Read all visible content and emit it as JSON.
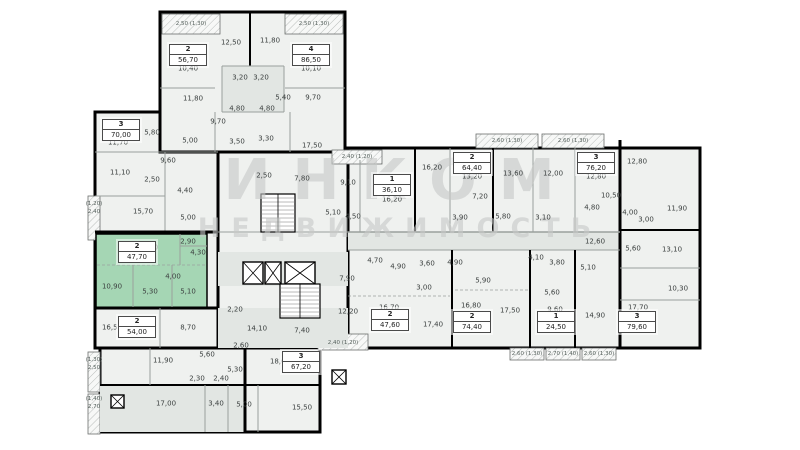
{
  "watermark": {
    "line1": "ИНКОМ",
    "line2": "НЕДВИЖИМОСТЬ"
  },
  "colors": {
    "highlight": "#a5d6b4",
    "wall": "#000000",
    "partition": "#9aa09d",
    "room_fill": "#eff1ef",
    "shaded_fill": "#e2e6e3",
    "balcony_stroke": "#6b6f6d",
    "label_text": "#3c4140",
    "watermark_gray": "#c7c9c8"
  },
  "selected_unit": {
    "rooms": "2",
    "area": "47,70"
  },
  "units": [
    {
      "rooms": "3",
      "area": "70,00",
      "x": 121,
      "y": 130,
      "selected": false
    },
    {
      "rooms": "2",
      "area": "47,70",
      "x": 137,
      "y": 252,
      "selected": true
    },
    {
      "rooms": "2",
      "area": "54,00",
      "x": 137,
      "y": 327,
      "selected": false
    },
    {
      "rooms": "2",
      "area": "56,70",
      "x": 188,
      "y": 55,
      "selected": false
    },
    {
      "rooms": "4",
      "area": "86,50",
      "x": 311,
      "y": 55,
      "selected": false
    },
    {
      "rooms": "1",
      "area": "36,10",
      "x": 392,
      "y": 185,
      "selected": false
    },
    {
      "rooms": "2",
      "area": "64,40",
      "x": 472,
      "y": 163,
      "selected": false
    },
    {
      "rooms": "3",
      "area": "76,20",
      "x": 596,
      "y": 163,
      "selected": false
    },
    {
      "rooms": "2",
      "area": "47,60",
      "x": 390,
      "y": 320,
      "selected": false
    },
    {
      "rooms": "2",
      "area": "74,40",
      "x": 472,
      "y": 322,
      "selected": false
    },
    {
      "rooms": "1",
      "area": "24,50",
      "x": 556,
      "y": 322,
      "selected": false
    },
    {
      "rooms": "3",
      "area": "79,60",
      "x": 637,
      "y": 322,
      "selected": false
    },
    {
      "rooms": "3",
      "area": "67,20",
      "x": 301,
      "y": 362,
      "selected": false
    }
  ],
  "room_labels": [
    {
      "t": "10,40",
      "x": 188,
      "y": 69
    },
    {
      "t": "12,50",
      "x": 231,
      "y": 43
    },
    {
      "t": "11,80",
      "x": 270,
      "y": 41
    },
    {
      "t": "10,10",
      "x": 311,
      "y": 69
    },
    {
      "t": "11,80",
      "x": 193,
      "y": 99
    },
    {
      "t": "3,20",
      "x": 240,
      "y": 78
    },
    {
      "t": "3,20",
      "x": 261,
      "y": 78
    },
    {
      "t": "5,40",
      "x": 283,
      "y": 98
    },
    {
      "t": "9,70",
      "x": 313,
      "y": 98
    },
    {
      "t": "4,80",
      "x": 237,
      "y": 109
    },
    {
      "t": "4,80",
      "x": 267,
      "y": 109
    },
    {
      "t": "9,70",
      "x": 218,
      "y": 122
    },
    {
      "t": "3,50",
      "x": 237,
      "y": 142
    },
    {
      "t": "3,30",
      "x": 266,
      "y": 139
    },
    {
      "t": "17,50",
      "x": 312,
      "y": 146
    },
    {
      "t": "5,00",
      "x": 190,
      "y": 141
    },
    {
      "t": "11,70",
      "x": 118,
      "y": 143
    },
    {
      "t": "5,80",
      "x": 152,
      "y": 133
    },
    {
      "t": "11,10",
      "x": 120,
      "y": 173
    },
    {
      "t": "2,50",
      "x": 152,
      "y": 180
    },
    {
      "t": "9,60",
      "x": 168,
      "y": 161
    },
    {
      "t": "4,40",
      "x": 185,
      "y": 191
    },
    {
      "t": "15,70",
      "x": 143,
      "y": 212
    },
    {
      "t": "5,00",
      "x": 188,
      "y": 218
    },
    {
      "t": "13,60",
      "x": 148,
      "y": 248
    },
    {
      "t": "2,90",
      "x": 188,
      "y": 242
    },
    {
      "t": "4,30",
      "x": 198,
      "y": 253
    },
    {
      "t": "10,90",
      "x": 112,
      "y": 287
    },
    {
      "t": "4,00",
      "x": 173,
      "y": 277
    },
    {
      "t": "5,30",
      "x": 150,
      "y": 292
    },
    {
      "t": "5,10",
      "x": 188,
      "y": 292
    },
    {
      "t": "16,50",
      "x": 112,
      "y": 328
    },
    {
      "t": "8,70",
      "x": 188,
      "y": 328
    },
    {
      "t": "2,20",
      "x": 235,
      "y": 310
    },
    {
      "t": "14,10",
      "x": 257,
      "y": 329
    },
    {
      "t": "7,40",
      "x": 302,
      "y": 331
    },
    {
      "t": "2,50",
      "x": 264,
      "y": 176
    },
    {
      "t": "7,80",
      "x": 302,
      "y": 179
    },
    {
      "t": "5,10",
      "x": 333,
      "y": 213
    },
    {
      "t": "4,50",
      "x": 353,
      "y": 217
    },
    {
      "t": "11,90",
      "x": 163,
      "y": 361
    },
    {
      "t": "5,60",
      "x": 207,
      "y": 355
    },
    {
      "t": "2,60",
      "x": 241,
      "y": 346
    },
    {
      "t": "5,30",
      "x": 235,
      "y": 370
    },
    {
      "t": "2,30",
      "x": 197,
      "y": 379
    },
    {
      "t": "2,40",
      "x": 221,
      "y": 379
    },
    {
      "t": "17,00",
      "x": 166,
      "y": 404
    },
    {
      "t": "3,40",
      "x": 216,
      "y": 404
    },
    {
      "t": "5,00",
      "x": 244,
      "y": 405
    },
    {
      "t": "15,50",
      "x": 302,
      "y": 408
    },
    {
      "t": "18,60",
      "x": 280,
      "y": 362
    },
    {
      "t": "9,10",
      "x": 348,
      "y": 183
    },
    {
      "t": "16,20",
      "x": 392,
      "y": 200
    },
    {
      "t": "16,20",
      "x": 432,
      "y": 168
    },
    {
      "t": "13,20",
      "x": 472,
      "y": 177
    },
    {
      "t": "7,20",
      "x": 480,
      "y": 197
    },
    {
      "t": "3,90",
      "x": 460,
      "y": 218
    },
    {
      "t": "5,80",
      "x": 503,
      "y": 217
    },
    {
      "t": "13,60",
      "x": 513,
      "y": 174
    },
    {
      "t": "12,00",
      "x": 553,
      "y": 174
    },
    {
      "t": "12,80",
      "x": 596,
      "y": 177
    },
    {
      "t": "12,80",
      "x": 637,
      "y": 162
    },
    {
      "t": "10,50",
      "x": 611,
      "y": 196
    },
    {
      "t": "4,80",
      "x": 592,
      "y": 208
    },
    {
      "t": "4,00",
      "x": 630,
      "y": 213
    },
    {
      "t": "3,00",
      "x": 646,
      "y": 220
    },
    {
      "t": "11,90",
      "x": 677,
      "y": 209
    },
    {
      "t": "3,10",
      "x": 543,
      "y": 218
    },
    {
      "t": "13,10",
      "x": 672,
      "y": 250
    },
    {
      "t": "5,60",
      "x": 633,
      "y": 249
    },
    {
      "t": "12,60",
      "x": 595,
      "y": 242
    },
    {
      "t": "10,30",
      "x": 678,
      "y": 289
    },
    {
      "t": "4,70",
      "x": 375,
      "y": 261
    },
    {
      "t": "4,90",
      "x": 398,
      "y": 267
    },
    {
      "t": "3,60",
      "x": 427,
      "y": 264
    },
    {
      "t": "4,90",
      "x": 455,
      "y": 263
    },
    {
      "t": "4,10",
      "x": 536,
      "y": 258
    },
    {
      "t": "3,80",
      "x": 557,
      "y": 263
    },
    {
      "t": "5,10",
      "x": 588,
      "y": 268
    },
    {
      "t": "5,60",
      "x": 552,
      "y": 293
    },
    {
      "t": "9,60",
      "x": 555,
      "y": 310
    },
    {
      "t": "7,90",
      "x": 347,
      "y": 279
    },
    {
      "t": "3,00",
      "x": 424,
      "y": 288
    },
    {
      "t": "5,90",
      "x": 483,
      "y": 281
    },
    {
      "t": "12,20",
      "x": 348,
      "y": 312
    },
    {
      "t": "16,70",
      "x": 389,
      "y": 308
    },
    {
      "t": "17,40",
      "x": 433,
      "y": 325
    },
    {
      "t": "16,80",
      "x": 471,
      "y": 306
    },
    {
      "t": "17,50",
      "x": 510,
      "y": 311
    },
    {
      "t": "14,90",
      "x": 595,
      "y": 316
    },
    {
      "t": "17,70",
      "x": 638,
      "y": 308
    }
  ],
  "balcony_labels": [
    {
      "t": "2,50 (1,30)",
      "x": 191,
      "y": 24
    },
    {
      "t": "2,50 (1,30)",
      "x": 314,
      "y": 24
    },
    {
      "t": "(1,20)",
      "x": 94,
      "y": 204
    },
    {
      "t": "2,40",
      "x": 94,
      "y": 212
    },
    {
      "t": "2,40 (1,20)",
      "x": 357,
      "y": 157
    },
    {
      "t": "2,60 (1,30)",
      "x": 507,
      "y": 141
    },
    {
      "t": "2,60 (1,30)",
      "x": 573,
      "y": 141
    },
    {
      "t": "(1,30)",
      "x": 94,
      "y": 360
    },
    {
      "t": "2,50",
      "x": 94,
      "y": 368
    },
    {
      "t": "(1,40)",
      "x": 94,
      "y": 399
    },
    {
      "t": "2,70",
      "x": 94,
      "y": 407
    },
    {
      "t": "2,40 (1,20)",
      "x": 343,
      "y": 343
    },
    {
      "t": "2,60 (1,30)",
      "x": 527,
      "y": 354
    },
    {
      "t": "2,70 (1,40)",
      "x": 563,
      "y": 354
    },
    {
      "t": "2,60 (1,30)",
      "x": 599,
      "y": 354
    }
  ],
  "geometry": {
    "blocks": [
      [
        95,
        112,
        123,
        236
      ],
      [
        218,
        152,
        130,
        196
      ],
      [
        100,
        348,
        220,
        84
      ],
      [
        160,
        12,
        185,
        140
      ],
      [
        348,
        148,
        352,
        200
      ]
    ],
    "green_unit": [
      96,
      234,
      111,
      74
    ],
    "shaded": [
      [
        218,
        252,
        130,
        34
      ],
      [
        348,
        232,
        272,
        18
      ],
      [
        222,
        66,
        62,
        46
      ],
      [
        100,
        385,
        145,
        47
      ],
      [
        218,
        308,
        130,
        40
      ]
    ],
    "walls": [
      [
        250,
        12,
        250,
        66,
        2
      ],
      [
        222,
        66,
        284,
        66,
        1
      ],
      [
        222,
        66,
        222,
        112,
        1
      ],
      [
        284,
        66,
        284,
        112,
        1
      ],
      [
        222,
        112,
        284,
        112,
        1
      ],
      [
        160,
        88,
        215,
        88,
        1
      ],
      [
        285,
        88,
        345,
        88,
        1
      ],
      [
        215,
        112,
        215,
        152,
        1
      ],
      [
        290,
        112,
        290,
        152,
        1
      ],
      [
        95,
        152,
        218,
        152,
        1
      ],
      [
        95,
        196,
        165,
        196,
        1
      ],
      [
        165,
        152,
        165,
        232,
        1
      ],
      [
        95,
        232,
        218,
        232,
        3
      ],
      [
        95,
        308,
        218,
        308,
        3
      ],
      [
        180,
        234,
        180,
        265,
        1
      ],
      [
        180,
        246,
        207,
        246,
        1
      ],
      [
        133,
        265,
        133,
        307,
        1
      ],
      [
        172,
        265,
        172,
        307,
        1
      ],
      [
        160,
        308,
        160,
        348,
        1
      ],
      [
        100,
        385,
        320,
        385,
        2
      ],
      [
        245,
        348,
        245,
        432,
        3
      ],
      [
        205,
        385,
        205,
        432,
        1
      ],
      [
        228,
        385,
        228,
        432,
        1
      ],
      [
        258,
        385,
        258,
        432,
        1
      ],
      [
        150,
        348,
        150,
        385,
        1
      ],
      [
        218,
        232,
        348,
        232,
        1
      ],
      [
        415,
        148,
        415,
        232,
        2
      ],
      [
        493,
        148,
        493,
        232,
        2
      ],
      [
        360,
        160,
        360,
        232,
        1
      ],
      [
        450,
        148,
        450,
        232,
        1
      ],
      [
        533,
        148,
        533,
        232,
        1
      ],
      [
        575,
        148,
        575,
        232,
        1
      ],
      [
        620,
        140,
        620,
        348,
        3
      ],
      [
        620,
        230,
        700,
        230,
        2
      ],
      [
        348,
        232,
        620,
        232,
        1.5
      ],
      [
        348,
        250,
        620,
        250,
        1
      ],
      [
        452,
        250,
        452,
        348,
        2
      ],
      [
        530,
        250,
        530,
        348,
        2
      ],
      [
        575,
        250,
        575,
        348,
        2
      ],
      [
        620,
        268,
        700,
        268,
        1
      ],
      [
        620,
        300,
        700,
        300,
        1
      ]
    ],
    "dashed": [
      [
        97,
        265,
        205,
        265
      ],
      [
        348,
        296,
        450,
        296
      ],
      [
        455,
        290,
        528,
        290
      ]
    ],
    "balconies": [
      [
        162,
        14,
        58,
        20
      ],
      [
        285,
        14,
        58,
        20
      ],
      [
        88,
        196,
        12,
        44
      ],
      [
        88,
        352,
        12,
        40
      ],
      [
        88,
        394,
        12,
        40
      ],
      [
        332,
        150,
        50,
        14
      ],
      [
        476,
        134,
        62,
        14
      ],
      [
        542,
        134,
        62,
        14
      ],
      [
        318,
        334,
        50,
        16
      ],
      [
        510,
        348,
        34,
        12
      ],
      [
        546,
        348,
        34,
        12
      ],
      [
        582,
        348,
        34,
        12
      ]
    ],
    "elevators": [
      [
        243,
        262,
        20,
        22
      ],
      [
        265,
        262,
        16,
        22
      ],
      [
        285,
        262,
        30,
        22
      ],
      [
        332,
        370,
        14,
        14
      ],
      [
        111,
        395,
        13,
        13
      ]
    ],
    "stairs": [
      [
        261,
        194,
        34,
        38
      ],
      [
        280,
        284,
        40,
        34
      ]
    ]
  }
}
